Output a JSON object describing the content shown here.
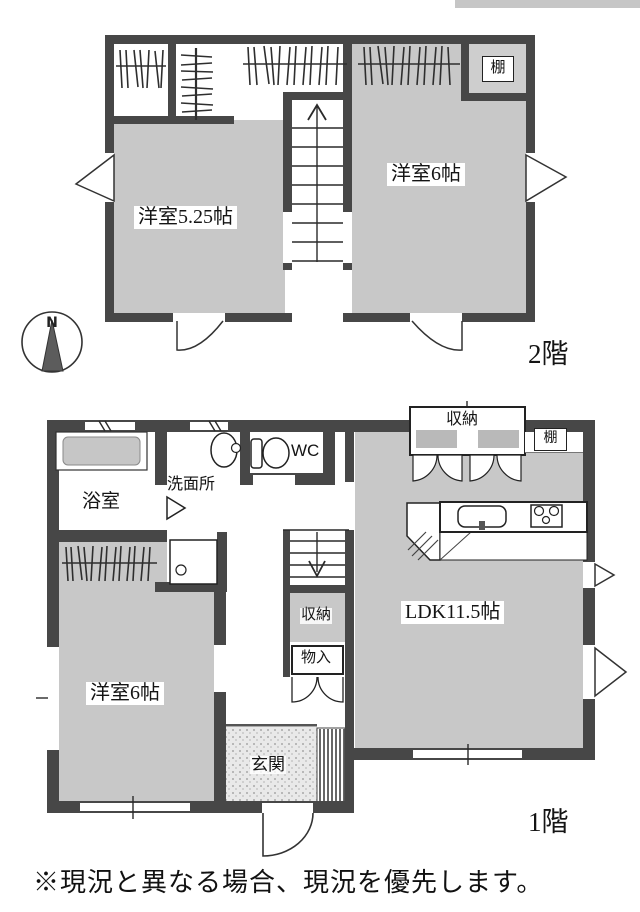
{
  "colors": {
    "wall": "#474747",
    "room_fill": "#c8c8c8",
    "line": "#222222",
    "scan_bar": "#c6c6c6"
  },
  "compass": {
    "north_label": "N"
  },
  "floor2": {
    "label": "2階",
    "room_west": "洋室5.25帖",
    "room_east": "洋室6帖",
    "shelf": "棚"
  },
  "floor1": {
    "label": "1階",
    "bathroom": "浴室",
    "washroom": "洗面所",
    "toilet": "WC",
    "stair_storage": "収納",
    "closet_small": "物入",
    "ldk": "LDK11.5帖",
    "ldk_storage": "収納",
    "shelf": "棚",
    "room_west": "洋室6帖",
    "entrance": "玄関"
  },
  "note": "※現況と異なる場合、現況を優先します。"
}
